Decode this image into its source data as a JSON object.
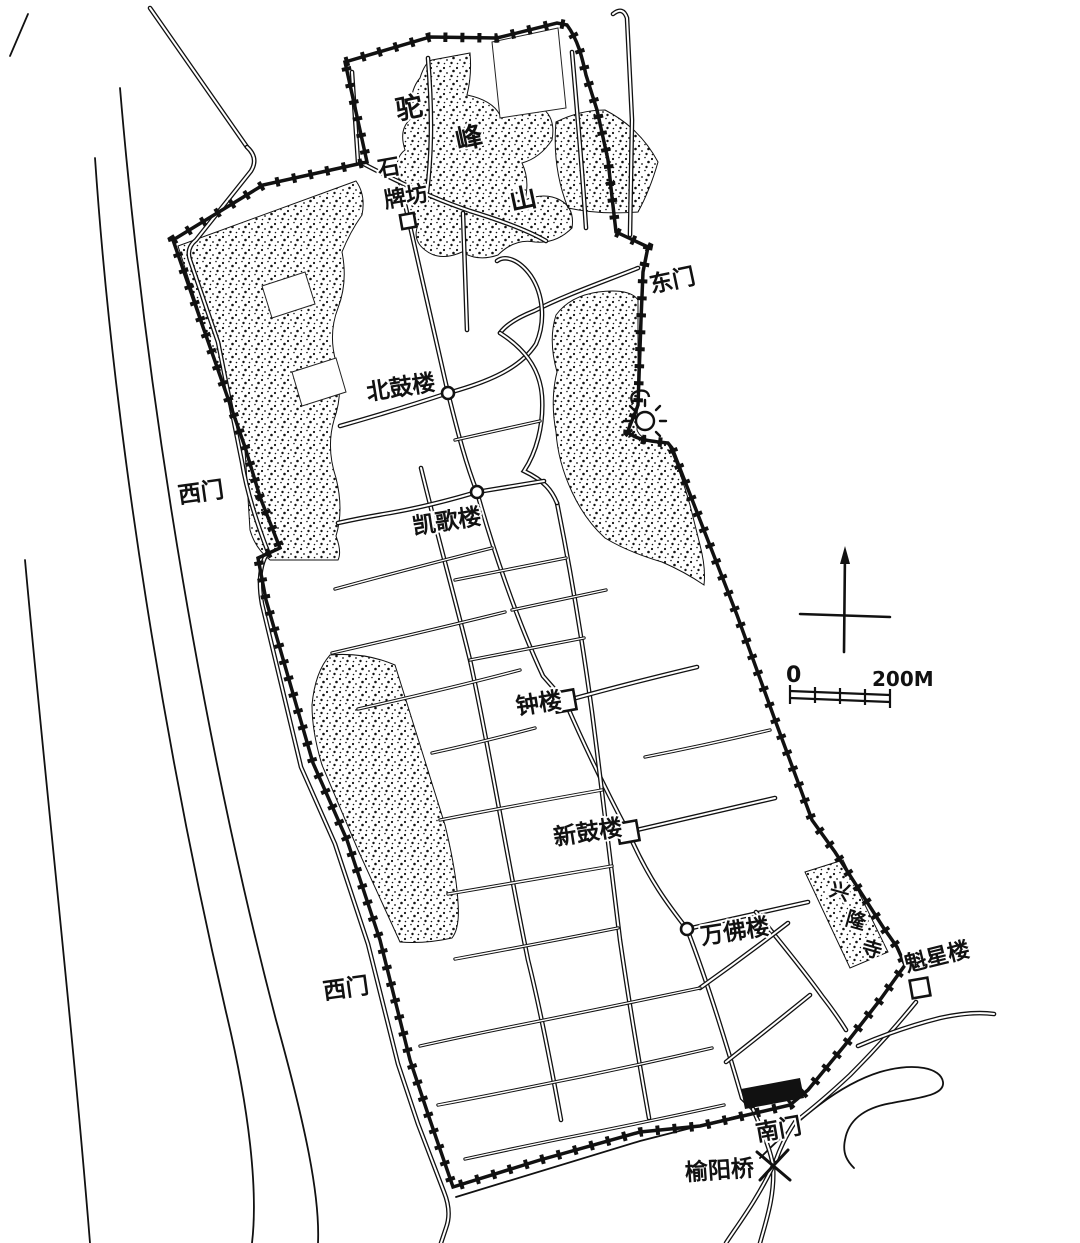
{
  "map": {
    "type": "hand-drawn historic city plan",
    "ink_color": "#111111",
    "paper_color": "#ffffff",
    "labels": [
      {
        "id": "tuofengshan-char-1",
        "text": "驼",
        "x": 411,
        "y": 117,
        "size": 27,
        "rotate": -12
      },
      {
        "id": "tuofengshan-char-2",
        "text": "峰",
        "x": 471,
        "y": 147,
        "size": 27,
        "rotate": -12
      },
      {
        "id": "tuofengshan-char-3",
        "text": "山",
        "x": 525,
        "y": 208,
        "size": 27,
        "rotate": -12
      },
      {
        "id": "shipaifang-line-1",
        "text": "石",
        "x": 390,
        "y": 175,
        "size": 22,
        "rotate": -10
      },
      {
        "id": "shipaifang-line-2",
        "text": "牌坊",
        "x": 407,
        "y": 204,
        "size": 22,
        "rotate": -10
      },
      {
        "id": "dongmen",
        "text": "东门",
        "x": 674,
        "y": 288,
        "size": 23,
        "rotate": -12
      },
      {
        "id": "beigulou",
        "text": "北鼓楼",
        "x": 402,
        "y": 395,
        "size": 23,
        "rotate": -9
      },
      {
        "id": "ximen-upper",
        "text": "西门",
        "x": 202,
        "y": 500,
        "size": 23,
        "rotate": -8
      },
      {
        "id": "kaigelou",
        "text": "凯歌楼",
        "x": 448,
        "y": 529,
        "size": 23,
        "rotate": -9
      },
      {
        "id": "zhonglou",
        "text": "钟楼",
        "x": 540,
        "y": 711,
        "size": 23,
        "rotate": -9
      },
      {
        "id": "xingulou",
        "text": "新鼓楼",
        "x": 589,
        "y": 840,
        "size": 23,
        "rotate": -9
      },
      {
        "id": "wanfolou",
        "text": "万佛楼",
        "x": 736,
        "y": 939,
        "size": 23,
        "rotate": -9
      },
      {
        "id": "xinglongsi-char-1",
        "text": "兴",
        "x": 838,
        "y": 898,
        "size": 20,
        "rotate": 16
      },
      {
        "id": "xinglongsi-char-2",
        "text": "隆",
        "x": 854,
        "y": 927,
        "size": 20,
        "rotate": 16
      },
      {
        "id": "xinglongsi-char-3",
        "text": "寺",
        "x": 870,
        "y": 956,
        "size": 20,
        "rotate": 16
      },
      {
        "id": "kuixinglou",
        "text": "魁星楼",
        "x": 939,
        "y": 964,
        "size": 22,
        "rotate": -14
      },
      {
        "id": "ximen-lower",
        "text": "西门",
        "x": 347,
        "y": 996,
        "size": 23,
        "rotate": -8
      },
      {
        "id": "nanmen",
        "text": "南门",
        "x": 780,
        "y": 1137,
        "size": 23,
        "rotate": -10
      },
      {
        "id": "yuyangqiao",
        "text": "榆阳桥",
        "x": 720,
        "y": 1178,
        "size": 23,
        "rotate": -4
      }
    ],
    "markers": [
      {
        "id": "shipaifang",
        "shape": "square",
        "x": 408,
        "y": 221,
        "size": 7
      },
      {
        "id": "beigulou",
        "shape": "circle",
        "x": 448,
        "y": 393,
        "size": 6
      },
      {
        "id": "kaigelou",
        "shape": "circle",
        "x": 477,
        "y": 492,
        "size": 6
      },
      {
        "id": "zhonglou",
        "shape": "square",
        "x": 565,
        "y": 701,
        "size": 10
      },
      {
        "id": "xingulou",
        "shape": "square",
        "x": 628,
        "y": 832,
        "size": 10
      },
      {
        "id": "wanfolou",
        "shape": "circle",
        "x": 687,
        "y": 929,
        "size": 6
      },
      {
        "id": "kuixinglou",
        "shape": "square",
        "x": 920,
        "y": 988,
        "size": 9
      }
    ],
    "scale_bar": {
      "zero_label": "0",
      "end_label": "200M"
    }
  }
}
